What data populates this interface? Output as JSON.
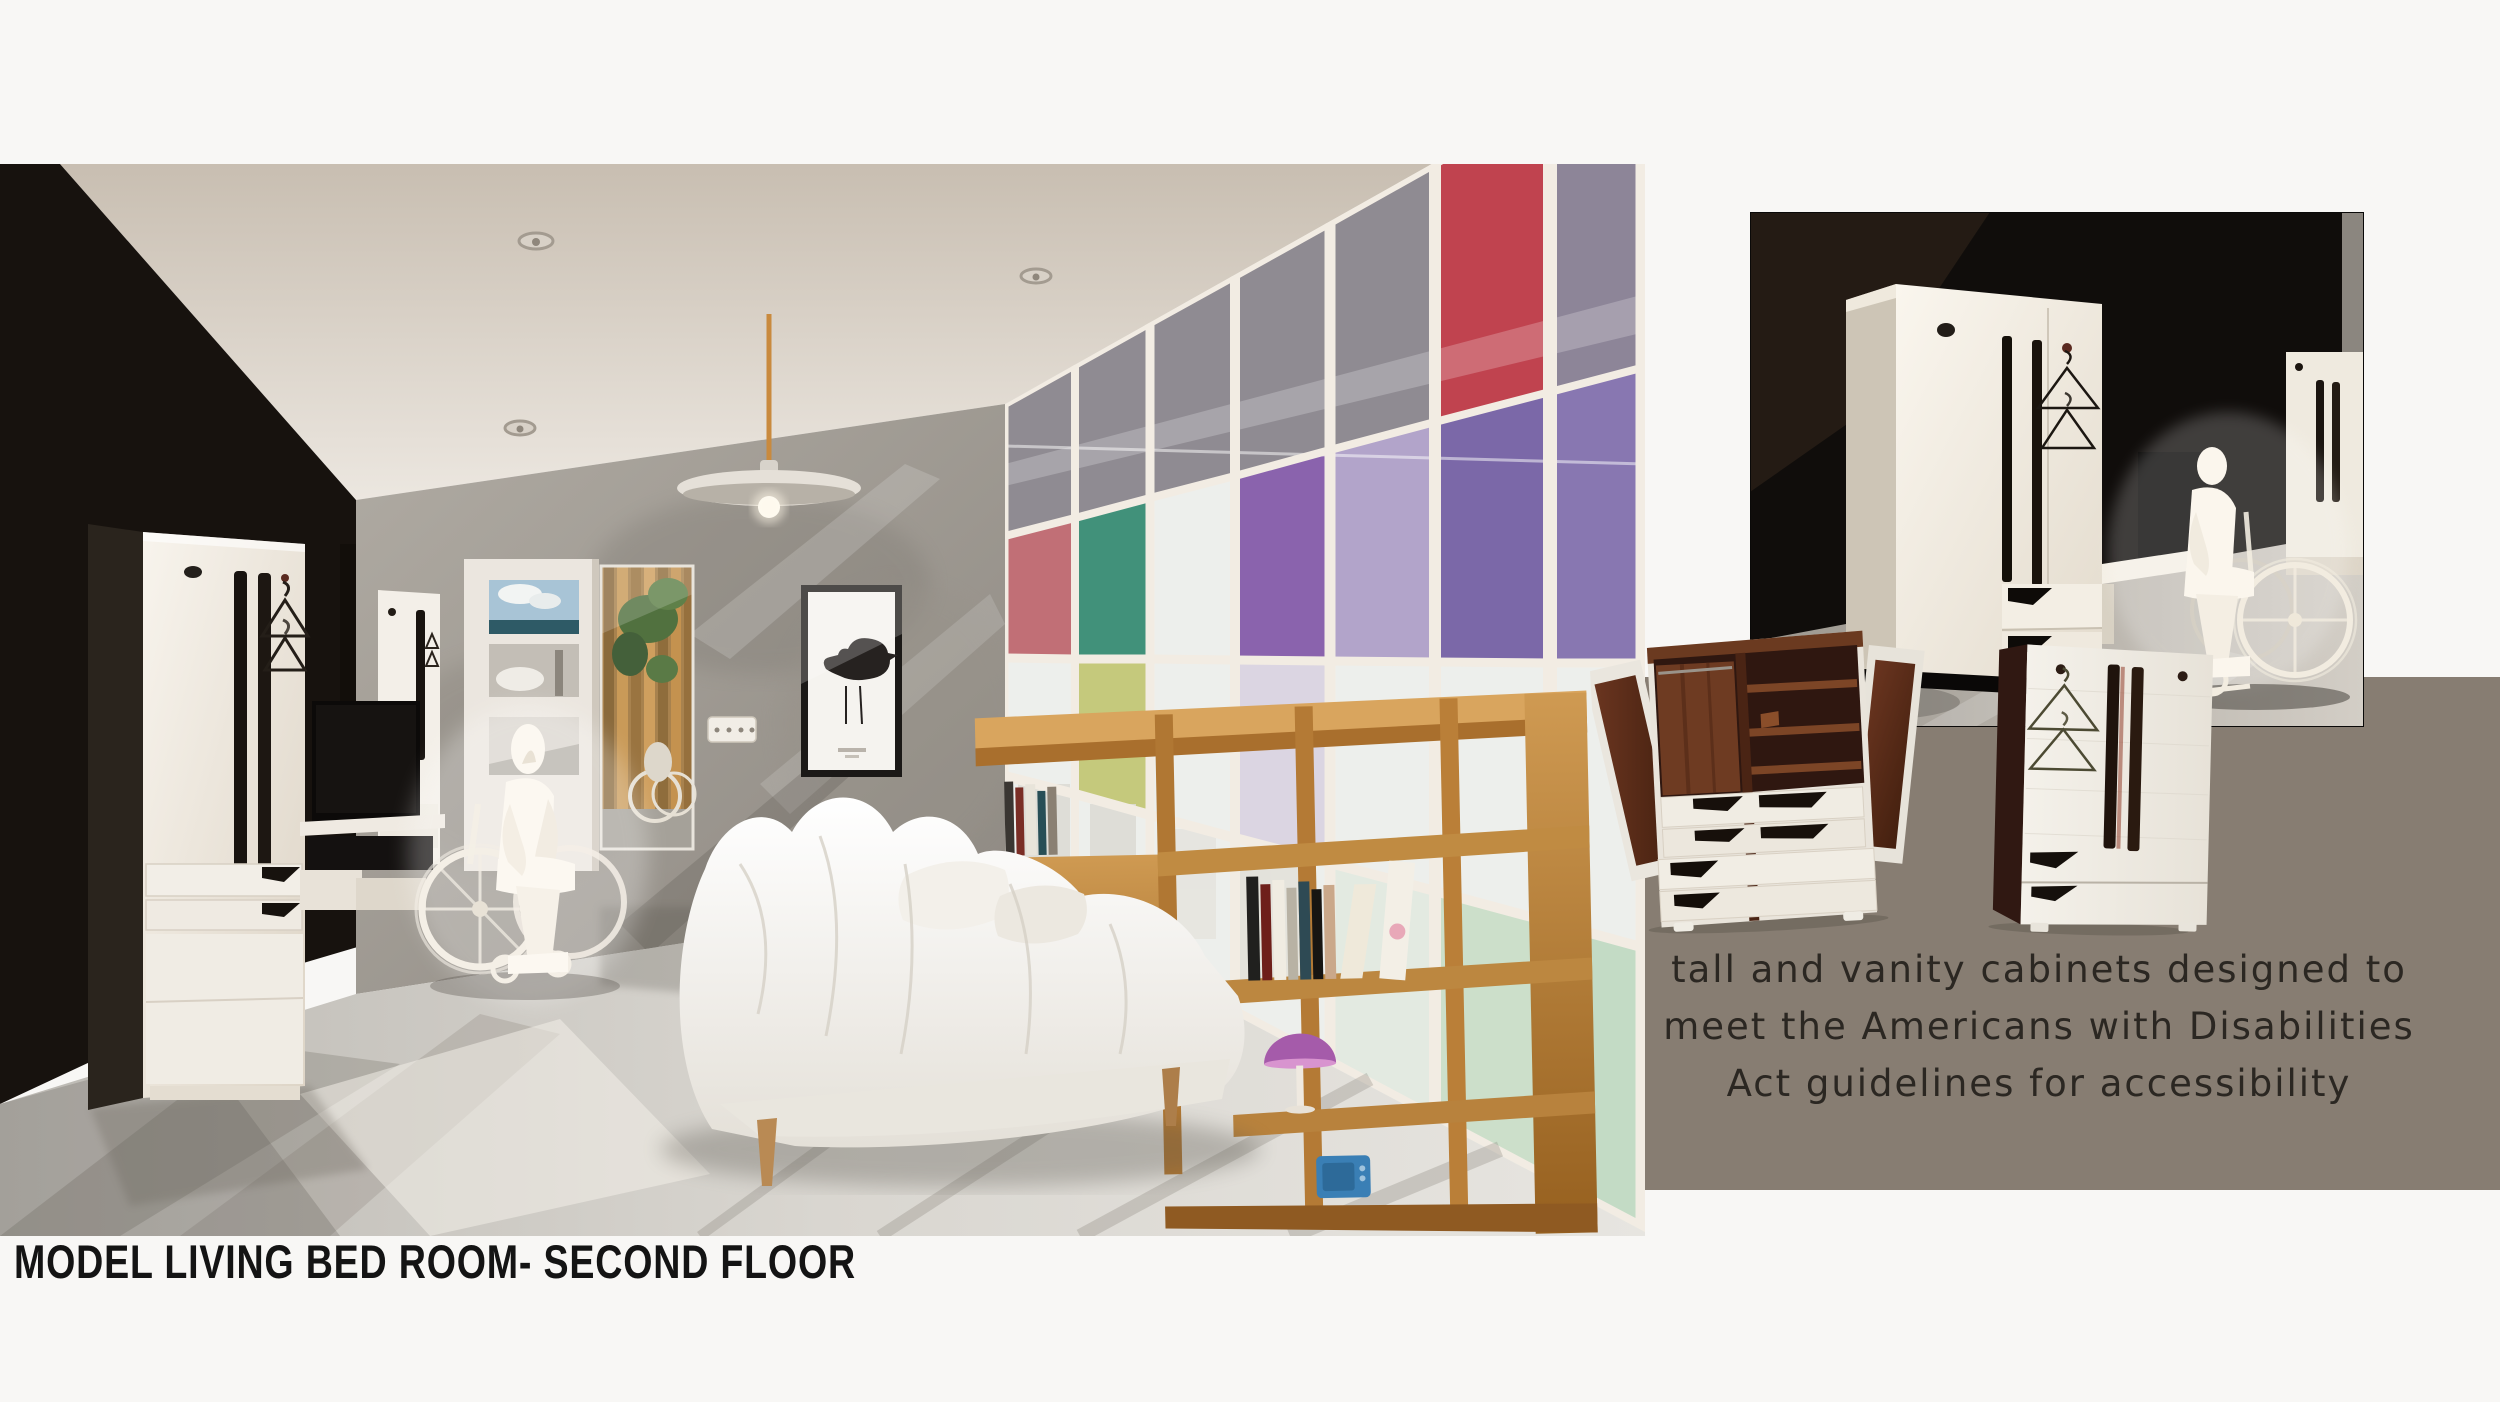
{
  "board": {
    "title": "MODEL LIVING BED ROOM- SECOND FLOOR"
  },
  "caption": {
    "lines": [
      "tall and vanity cabinets designed to",
      "meet the Americans with Disabilities",
      "Act guidelines for accessibility"
    ]
  },
  "figures": {
    "main_render": {
      "alt": "Interior render of the model living bedroom: wheelchair user beside a mirrored panel, white bed, oak bookshelf room divider and a colored glass partition wall"
    },
    "ada_render": {
      "alt": "Dark render of ADA compliant white wardrobe cabinets with a wheelchair user"
    },
    "open_cabinet": {
      "alt": "Tall cabinet opened showing mahogany interior shelves and accessible white drawers"
    },
    "closed_cabinet": {
      "alt": "Tall cabinet closed with long pull handles and wire hangers"
    }
  },
  "palette": {
    "page_bg": "#f8f7f5",
    "caption_panel": "#877d72",
    "title_color": "#141414",
    "caption_color": "#2b2722",
    "wood_accent": "#b97a3f",
    "glass_red": "#c0434f",
    "glass_purple": "#8a63ad",
    "glass_green": "#41917a"
  }
}
